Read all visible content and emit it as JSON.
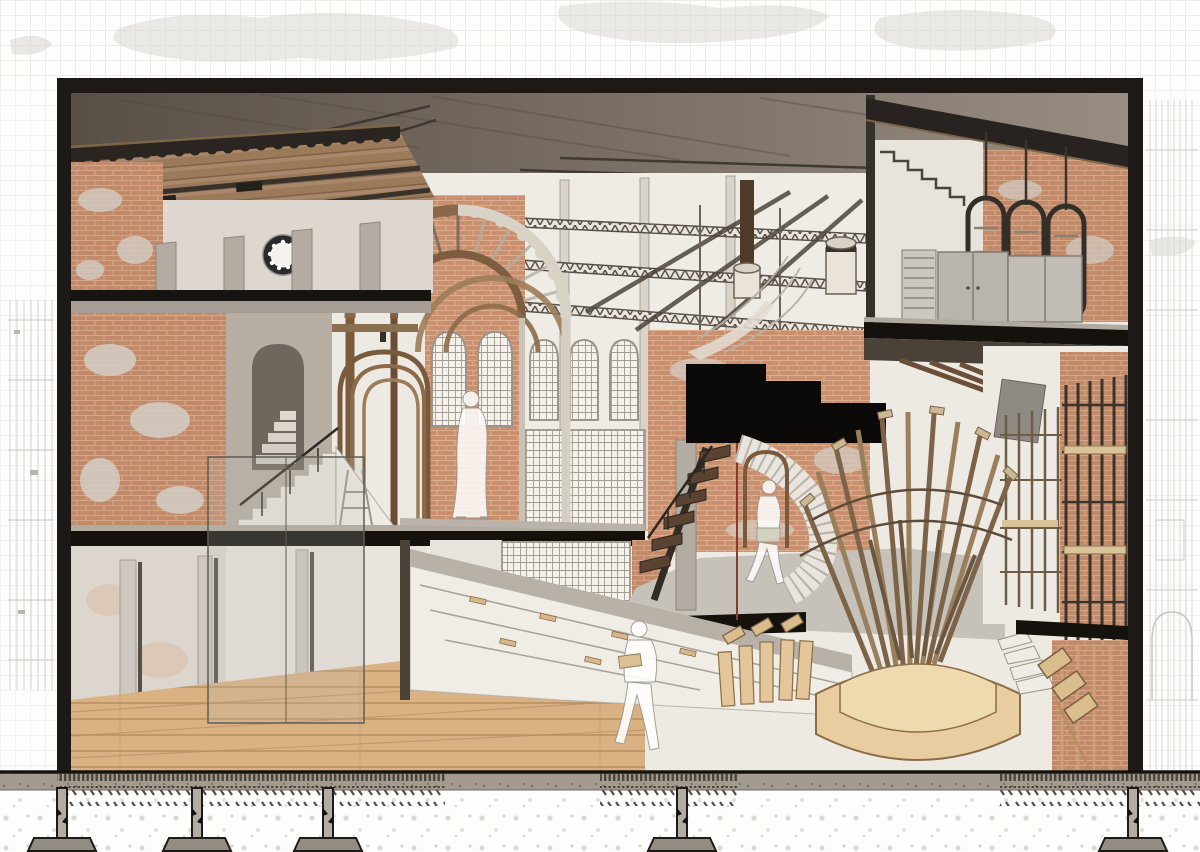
{
  "meta": {
    "kind": "architectural-sectional-perspective",
    "aria_label": "Cutaway sectional perspective collage of a renovated industrial brick hall with tiled eave, timber barrel arches, steel roof trusses, hanging capsule racks, a fan-shaped timber installation, angled book display wedge, ghost figures and a technical foundation detail below",
    "visible_text": ""
  },
  "palette": {
    "frame_black": "#1c1917",
    "ceiling_concrete": "#6b6158",
    "roof_tile": "#2b2521",
    "brick": "#c18a6a",
    "brick_light": "#c9906f",
    "plaster": "#d8d2cb",
    "timber": "#8a684a",
    "timber_dark": "#5a4330",
    "plywood": "#e7cd9f",
    "black_volume": "#0b0a08",
    "ground_slab": "#a39b90",
    "soil_hatch": "#564f47",
    "ghost_figure": "#ffffff"
  },
  "scene": {
    "frame": {
      "x": 57,
      "y": 78,
      "width": 1086,
      "height": 696
    },
    "figures": [
      {
        "id": "figure-walking-mezzanine",
        "x": 471,
        "y": 399
      },
      {
        "id": "figure-reading-book",
        "x": 639,
        "y": 629
      },
      {
        "id": "figure-walking-right",
        "x": 769,
        "y": 487
      }
    ],
    "foundation": {
      "pier_x": [
        62,
        197,
        328,
        682,
        1133
      ],
      "footing_y": 838,
      "ground_y": 772
    },
    "hanging_racks": {
      "count": 3
    },
    "nested_timber_arches": {
      "count": 3
    },
    "black_volume_steps": 3,
    "rose_window": {
      "cx": 283,
      "cy": 255,
      "r": 16
    }
  }
}
